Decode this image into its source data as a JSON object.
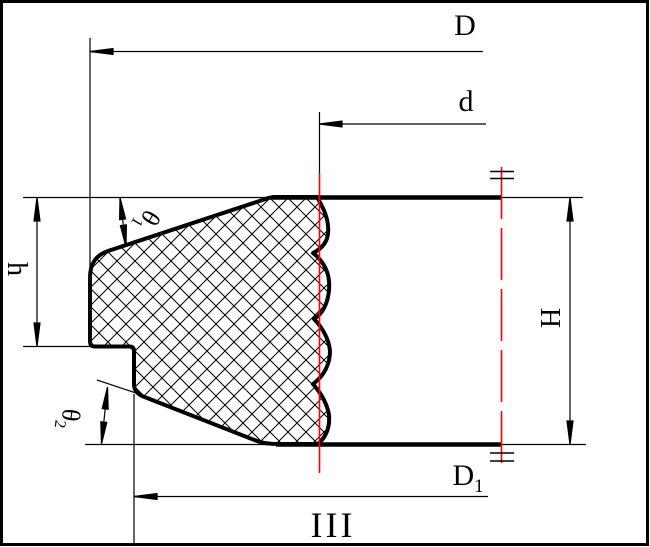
{
  "drawing": {
    "kind": "sectional-technical-drawing",
    "section_mark": "III",
    "colors": {
      "line": "#000000",
      "highlight": "#ff0000",
      "background": "#ffffff"
    },
    "labels": {
      "outer_diameter": {
        "main": "D",
        "sub": ""
      },
      "inner_diameter": {
        "main": "d",
        "sub": ""
      },
      "bottom_diameter": {
        "main": "D",
        "sub": "1"
      },
      "total_height": {
        "main": "H",
        "sub": ""
      },
      "flange_height": {
        "main": "h",
        "sub": ""
      },
      "top_angle": {
        "main": "θ",
        "sub": "1"
      },
      "bottom_angle": {
        "main": "θ",
        "sub": "2"
      },
      "section": {
        "main": "III",
        "sub": ""
      }
    }
  }
}
